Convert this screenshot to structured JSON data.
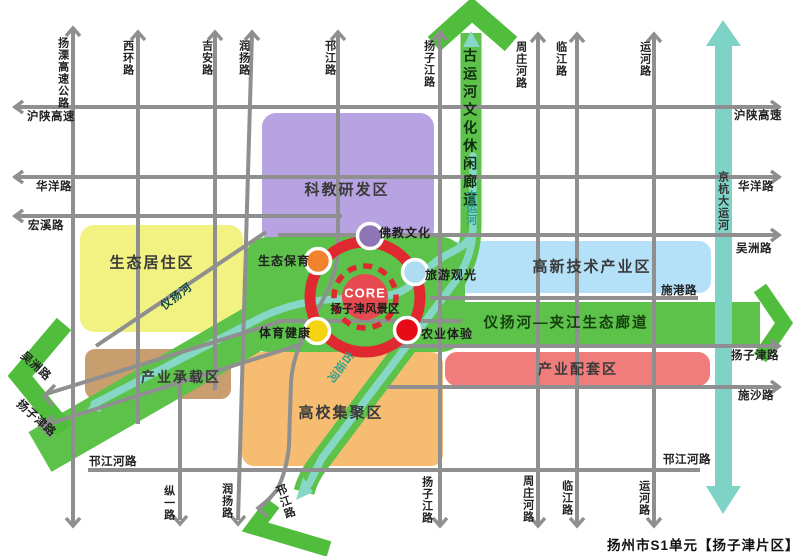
{
  "caption": "扬州市S1单元【扬子津片区】控制",
  "core": {
    "label": "CORE",
    "name": "扬子津风景区"
  },
  "zones": {
    "keyan": "科教研发区",
    "juzhu": "生态居住区",
    "gaoxin": "高新技术产业区",
    "chengzai": "产业承载区",
    "gaoxiao": "高校集聚区",
    "peitao": "产业配套区"
  },
  "corridors": {
    "guyunhe": "古运河文化休闲廊道",
    "shengtai": "仪扬河—夹江生态廊道"
  },
  "rivers": {
    "jinghang": "京杭大运河",
    "guyunhe": "古运河",
    "yiyang": "仪扬河"
  },
  "nodes": {
    "fojiao": "佛教文化",
    "baoyu": "生态保育",
    "lvyou": "旅游观光",
    "tiyu": "体育健康",
    "nongye": "农业体验"
  },
  "roads": {
    "yangli": "扬溧高速公路",
    "xihuan": "西环路",
    "jian": "吉安路",
    "runyang": "润扬路",
    "hanjiang": "邗江路",
    "yangzijiang": "扬子江路",
    "zhouzhuanghe": "周庄河路",
    "linjiang": "临江路",
    "yunhe": "运河路",
    "zongyi": "纵一路",
    "hushan": "沪陕高速",
    "huayang": "华洋路",
    "hongxi": "宏溪路",
    "wuzhou": "吴洲路",
    "yangzijin": "扬子津路",
    "shigang": "施港路",
    "shisha": "施沙路",
    "hanjianghe": "邗江河路"
  },
  "palette": {
    "green": "#5cc24a",
    "green_arrow": "#50bd3c",
    "teal": "#86d7c6",
    "teal_canal": "#7fd3c6",
    "purple_zone": "#b7a2e2",
    "yellow_zone": "#f2f282",
    "blue_zone": "#b4e1f7",
    "tan_zone": "#c99e6e",
    "orange_zone": "#f6bc71",
    "red_zone": "#f17c7c",
    "ring": "#e02830",
    "core_fill": "#e64a50",
    "road": "#8f8f8f",
    "dot_fojiao": "#8d76b3",
    "dot_baoyu": "#f1832e",
    "dot_lvyou": "#aedcf2",
    "dot_tiyu": "#f4d313",
    "dot_nongye": "#e60b17"
  }
}
